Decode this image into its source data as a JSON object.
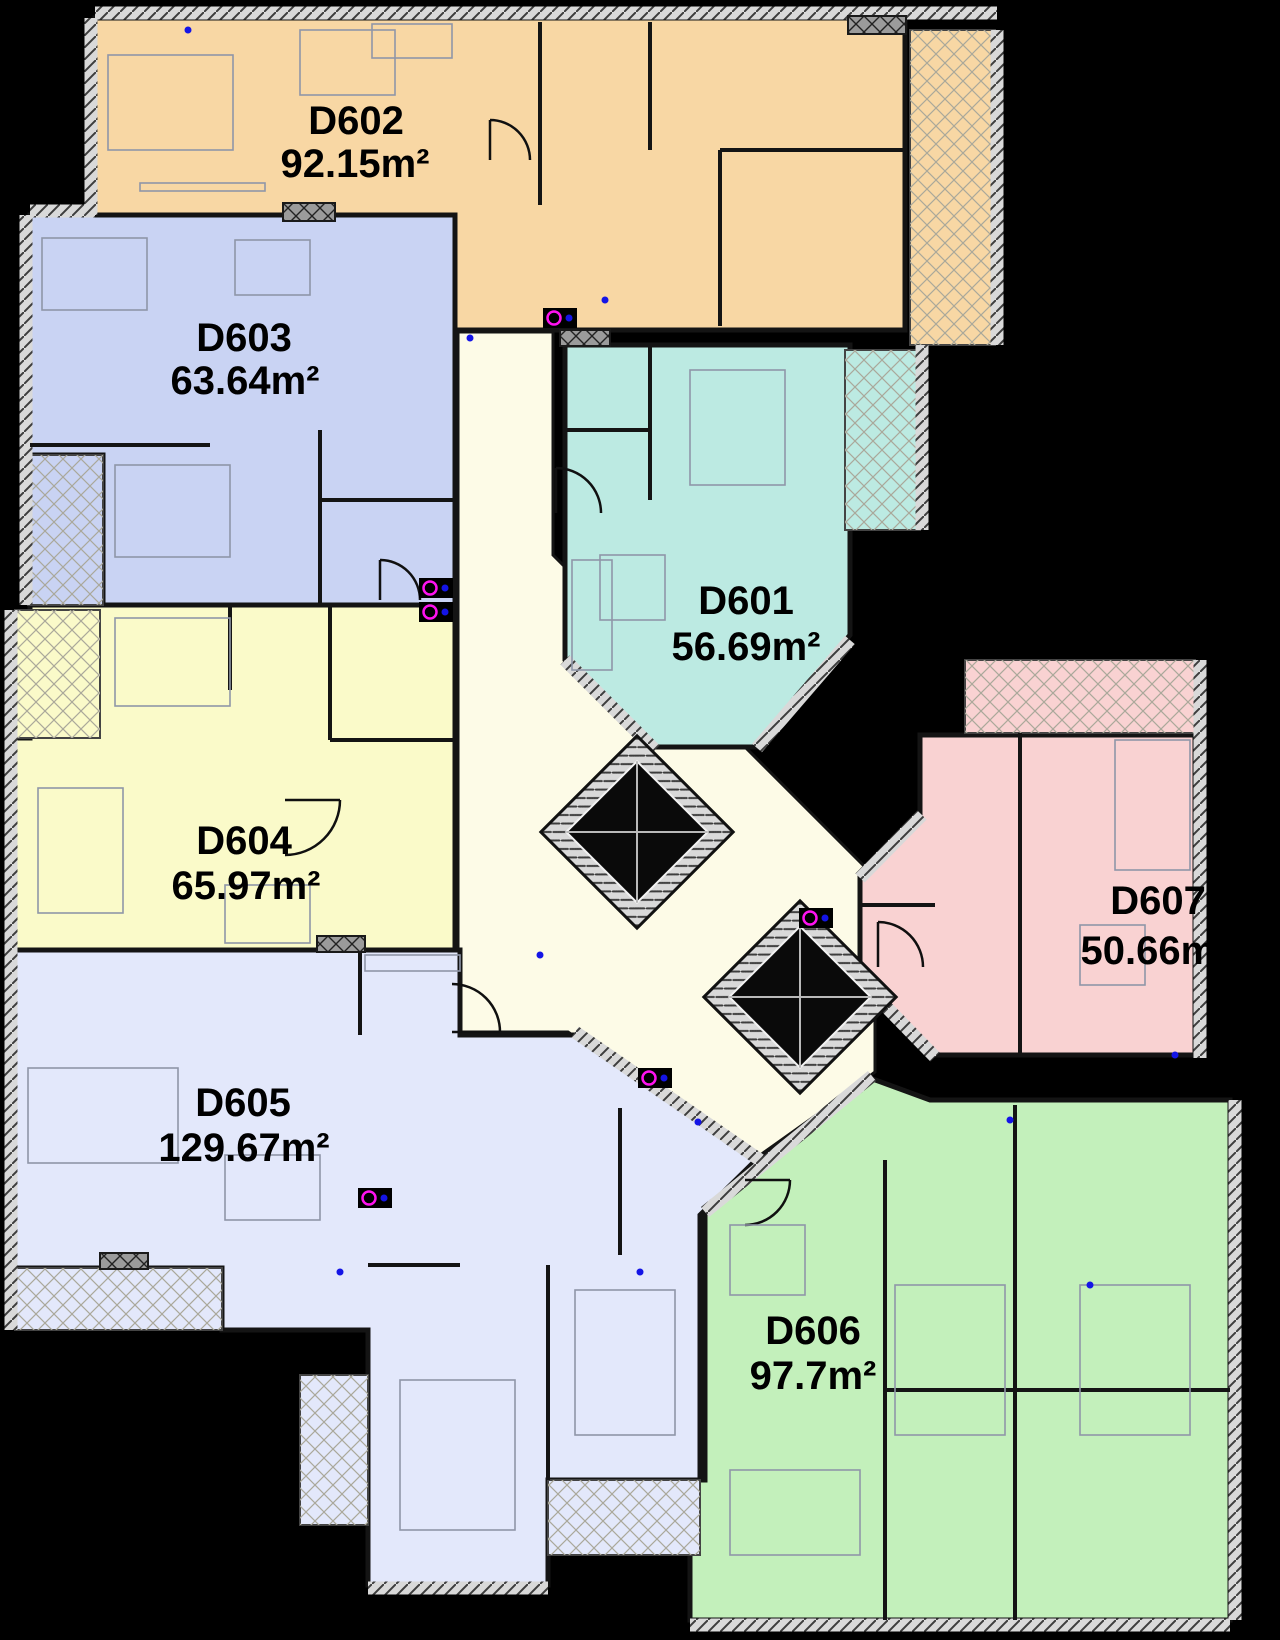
{
  "plan": {
    "title": "Floor plan level 6",
    "background": "#000000",
    "corridor_color": "#FDFBE7",
    "wall_color": "#141414",
    "elevator_label": "elevator-shaft"
  },
  "apartments": [
    {
      "id": "d602",
      "name": "D602",
      "area": "92.15m²",
      "color": "#F8D7A4"
    },
    {
      "id": "d603",
      "name": "D603",
      "area": "63.64m²",
      "color": "#C9D3F3"
    },
    {
      "id": "d601",
      "name": "D601",
      "area": "56.69m²",
      "color": "#BCEAE2"
    },
    {
      "id": "d604",
      "name": "D604",
      "area": "65.97m²",
      "color": "#FAFAC9"
    },
    {
      "id": "d605",
      "name": "D605",
      "area": "129.67m²",
      "color": "#E3E8FB"
    },
    {
      "id": "d607",
      "name": "D607",
      "area": "50.66m²",
      "color": "#F9D2D2"
    },
    {
      "id": "d606",
      "name": "D606",
      "area": "97.7m²",
      "color": "#C3F0BB"
    }
  ]
}
